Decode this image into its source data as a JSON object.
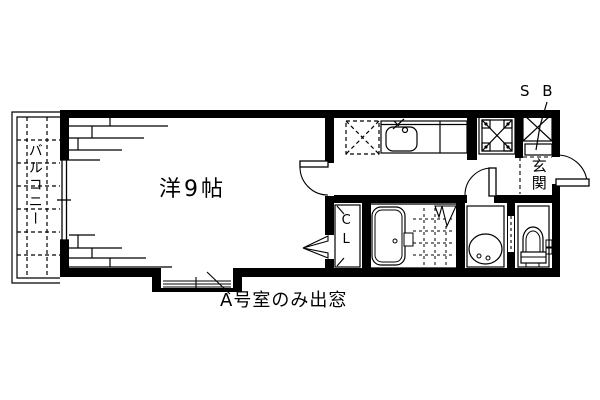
{
  "meta": {
    "background_color": "#ffffff",
    "line_color": "#000000",
    "drawing_type": "apartment floor plan"
  },
  "floorplan": {
    "room_label": "洋9帖",
    "balcony_label": "バルコニー",
    "entrance_label": "玄関",
    "closet_label": "CL",
    "shoebox_label": "S B",
    "note": "A号室のみ出窓"
  }
}
